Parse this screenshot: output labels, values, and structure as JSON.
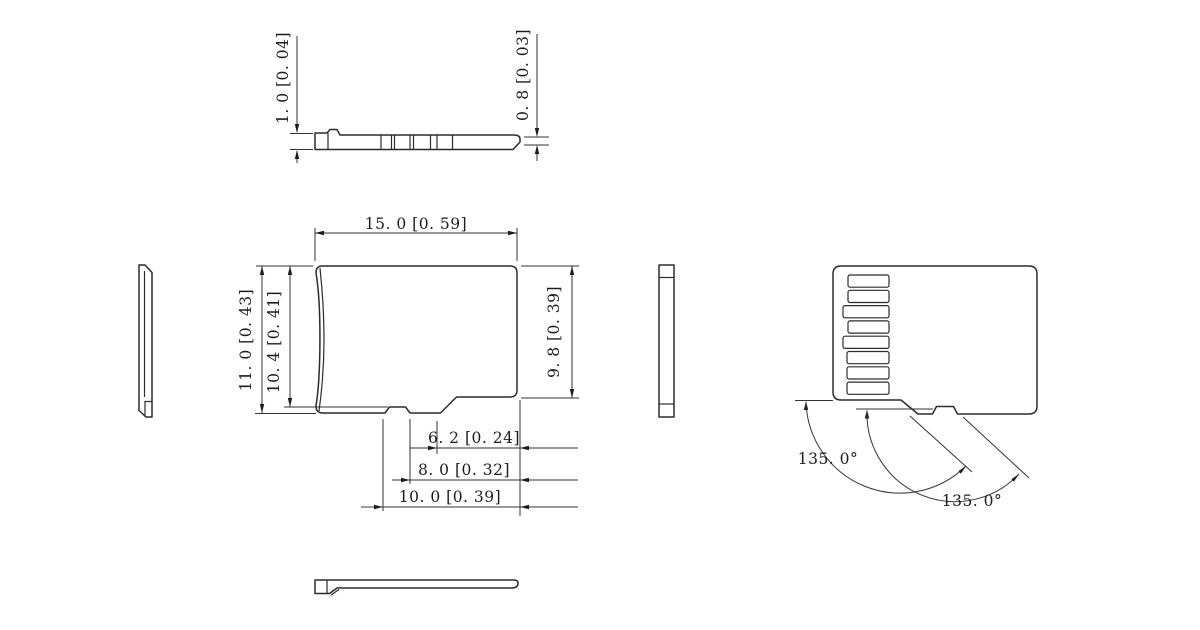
{
  "drawing": {
    "colors": {
      "background": "#ffffff",
      "line": "#2b2b2b"
    },
    "back_view": {
      "pad_count": 8
    }
  },
  "labels": {
    "top_profile_thickness": "1. 0 [0. 04]",
    "top_profile_tip_thickness": "0. 8 [0. 03]",
    "front_width": "15. 0 [0. 59]",
    "front_height": "11. 0 [0. 43]",
    "front_height_to_notch": "10. 4 [0. 41]",
    "front_right_height": "9. 8 [0. 39]",
    "front_notch_offset_1": "6. 2 [0. 24]",
    "front_notch_offset_2": "8. 0 [0. 32]",
    "front_notch_offset_3": "10. 0 [0. 39]",
    "back_angle_left": "135. 0°",
    "back_angle_right": "135. 0°"
  }
}
